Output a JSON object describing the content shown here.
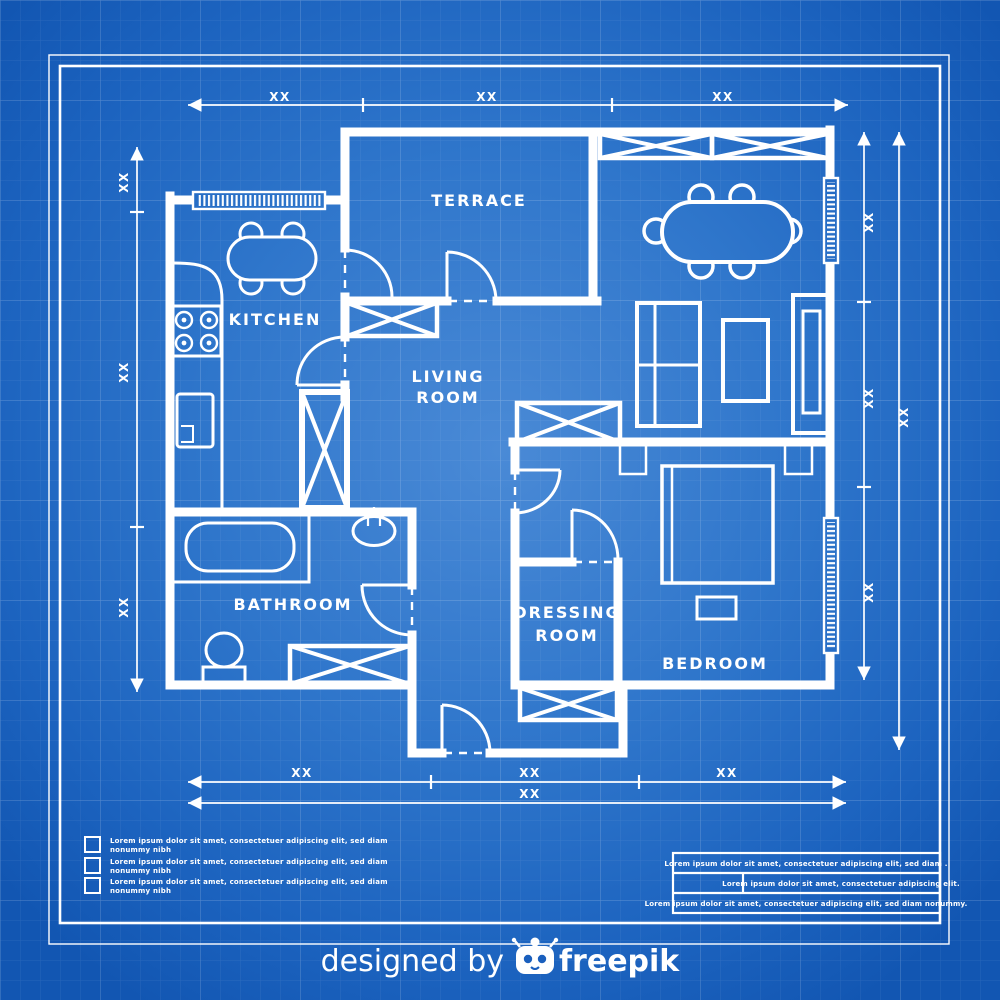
{
  "title": "House floor plan blueprint",
  "colors": {
    "background_center": "#4a8ad6",
    "background_mid": "#2f76cb",
    "background_edge": "#1256b2",
    "line": "#ffffff"
  },
  "rooms": {
    "terrace": "TERRACE",
    "kitchen": "KITCHEN",
    "living_line1": "LIVING",
    "living_line2": "ROOM",
    "bathroom": "BATHROOM",
    "dressing_line1": "DRESSING",
    "dressing_line2": "ROOM",
    "bedroom": "BEDROOM"
  },
  "dimensions": {
    "top": [
      "XX",
      "XX",
      "XX"
    ],
    "left": [
      "XX",
      "XX",
      "XX"
    ],
    "right_inner": [
      "XX",
      "XX",
      "XX"
    ],
    "right_outer": [
      "XX"
    ],
    "bottom_inner": [
      "XX",
      "XX",
      "XX"
    ],
    "bottom_outer": [
      "XX"
    ]
  },
  "legend": {
    "items": [
      {
        "line1": "Lorem ipsum dolor sit amet, consectetuer adipiscing elit, sed diam",
        "line2": "nonummy nibh"
      },
      {
        "line1": "Lorem ipsum dolor sit amet, consectetuer adipiscing elit, sed diam",
        "line2": "nonummy nibh"
      },
      {
        "line1": "Lorem ipsum dolor sit amet, consectetuer adipiscing elit, sed diam",
        "line2": "nonummy nibh"
      }
    ]
  },
  "title_block": {
    "rows": [
      {
        "text": "Lorem ipsum dolor sit amet, consectetuer adipiscing elit, sed diam ."
      },
      {
        "text": "Lorem ipsum dolor sit amet, consectetuer adipiscing elit."
      },
      {
        "text": "Lorem ipsum dolor sit amet, consectetuer adipiscing elit, sed diam nonummy."
      }
    ]
  },
  "footer": {
    "designed_by": "designed by",
    "brand": "freepik"
  }
}
